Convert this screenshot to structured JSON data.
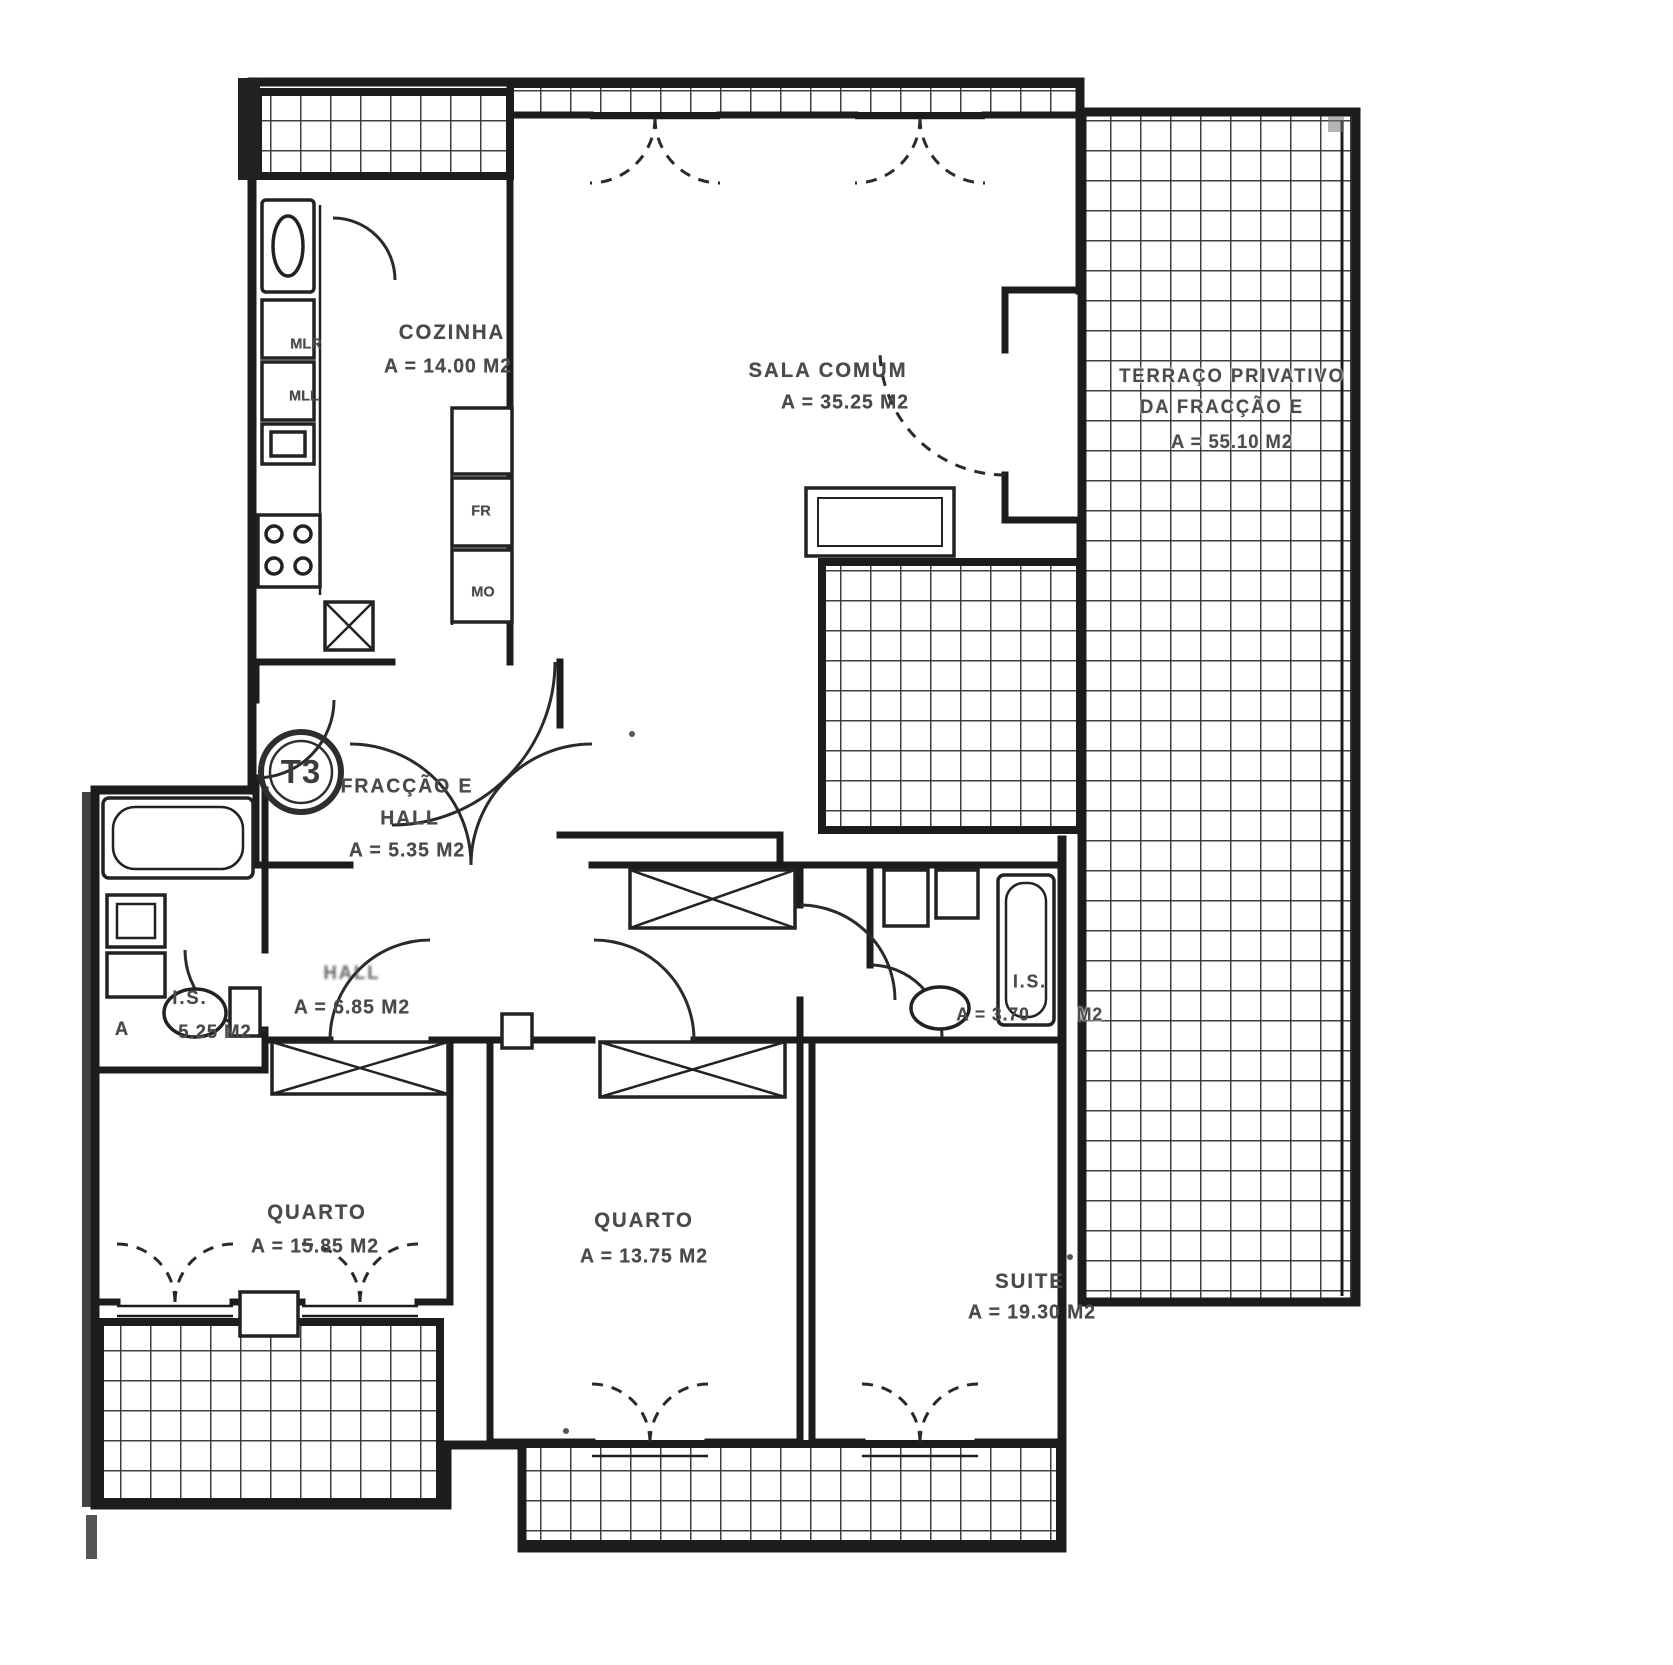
{
  "document": {
    "kind": "apartment floor plan (scanned)",
    "unit_type_badge": "T3"
  },
  "rooms": {
    "cozinha": {
      "name": "COZINHA",
      "area": "A = 14.00 M2"
    },
    "sala": {
      "name": "SALA COMUM",
      "area": "A = 35.25 M2"
    },
    "terraco": {
      "line1": "TERRAÇO PRIVATIVO",
      "line2": "DA FRACÇÃO E",
      "area": "A = 55.10 M2"
    },
    "fraccao_hall": {
      "line1": "FRACÇÃO E",
      "line2": "HALL",
      "area": "A = 5.35 M2"
    },
    "hall": {
      "name": "HALL",
      "area": "A = 6.85 M2"
    },
    "is_left": {
      "name": "I.S.",
      "prefix": "A",
      "area": "5.25 M2"
    },
    "is_right": {
      "name": "I.S.",
      "area": "A = 3.70",
      "unit": "M2"
    },
    "quarto_1": {
      "name": "QUARTO",
      "area": "A = 15.85 M2"
    },
    "quarto_2": {
      "name": "QUARTO",
      "area": "A = 13.75 M2"
    },
    "suite": {
      "name": "SUITE",
      "area": "A = 19.30 M2"
    }
  },
  "appliances": {
    "mlr": "MLR",
    "mll": "MLL",
    "fr": "FR",
    "mo": "MO"
  },
  "colors": {
    "paper": "#ffffff",
    "ink": "#4a4a4a",
    "wall": "#1c1c1c",
    "tile_line": "#3f3f3f"
  }
}
